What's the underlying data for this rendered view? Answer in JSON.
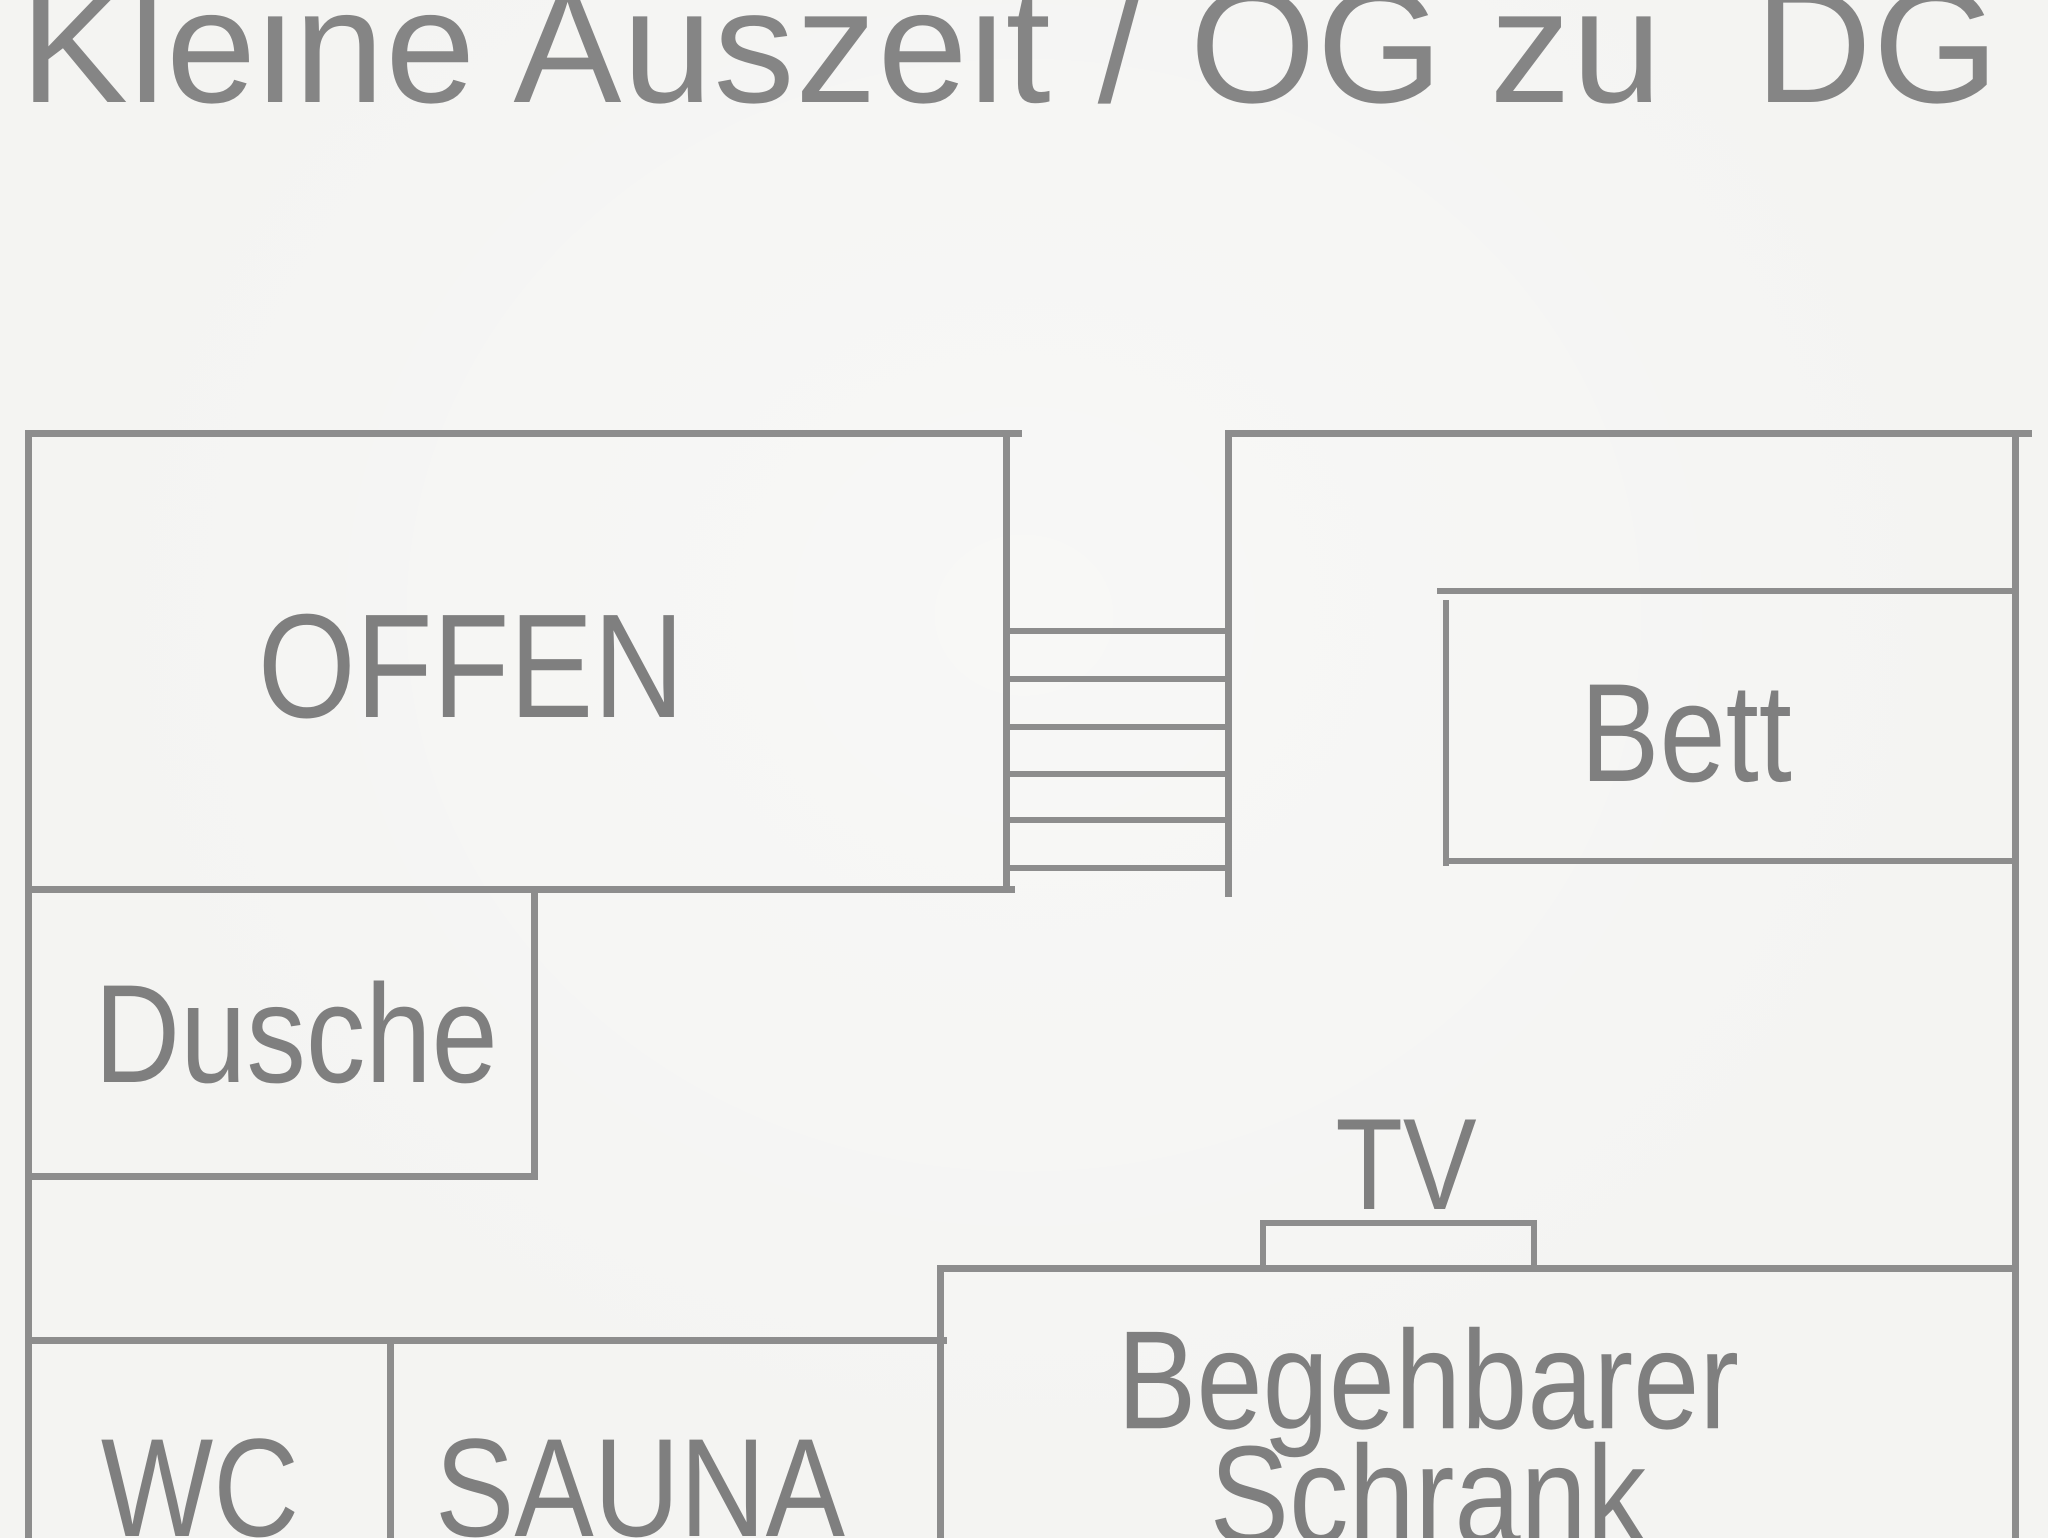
{
  "title": "Kleine Auszeit / OG zu  DG",
  "floorplan": {
    "rooms": [
      {
        "id": "offen",
        "label": "OFFEN"
      },
      {
        "id": "dusche",
        "label": "Dusche"
      },
      {
        "id": "bett",
        "label": "Bett"
      },
      {
        "id": "tv",
        "label": "TV"
      },
      {
        "id": "wc",
        "label": "WC"
      },
      {
        "id": "sauna",
        "label": "SAUNA"
      },
      {
        "id": "schrank",
        "label": "Begehbarer Schrank",
        "line1": "Begehbarer",
        "line2": "Schrank"
      }
    ],
    "stairs": {
      "step_count": 6,
      "location": "between OFFEN room and bedroom"
    },
    "colors": {
      "wall": "#8d8d8d",
      "label_text": "#7f7f7f",
      "title_text": "#858585",
      "background": "#f4f4f2"
    }
  }
}
